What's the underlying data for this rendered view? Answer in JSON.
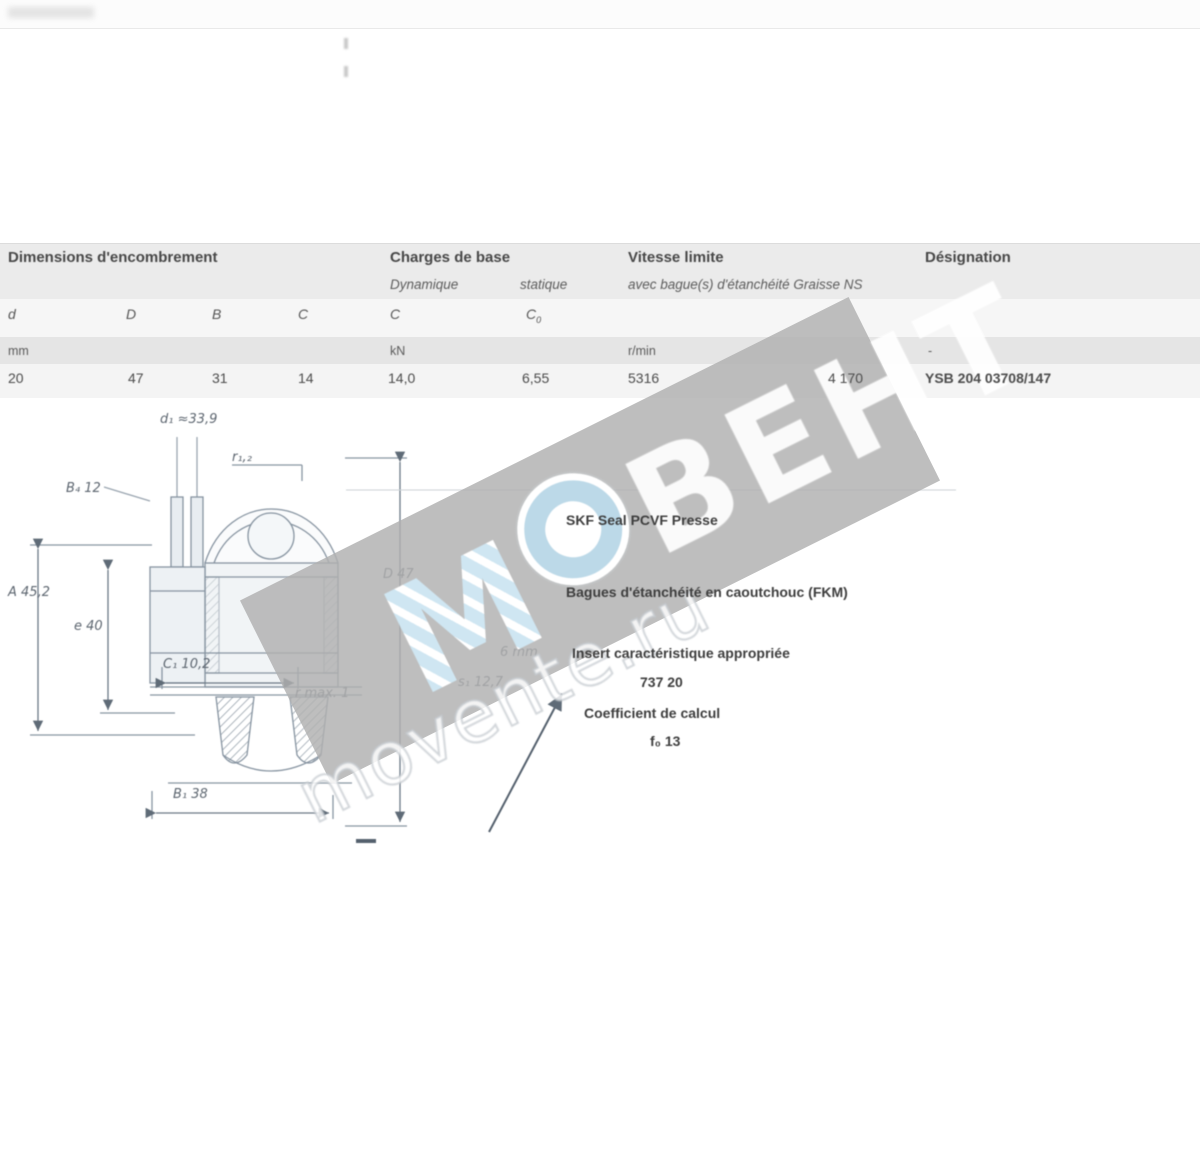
{
  "table": {
    "group1": "Dimensions d'encombrement",
    "group2": "Charges de base",
    "group2_sub1": "Dynamique",
    "group2_sub2": "statique",
    "group3": "Vitesse limite",
    "group3_sub": "avec bague(s) d'étanchéité Graisse NS",
    "group4": "Désignation",
    "symbols": {
      "s1": "d",
      "s2": "D",
      "s3": "B",
      "s4": "C",
      "s5": "C",
      "s6_base": "C",
      "s6_sub": "0"
    },
    "units": {
      "u1": "mm",
      "u2": "kN",
      "u3": "r/min",
      "u4": "-"
    },
    "row": {
      "d": "20",
      "D": "47",
      "B": "31",
      "C": "14",
      "c_dyn": "14,0",
      "c0": "6,55",
      "speed1": "5316",
      "speed2": "4 170",
      "designation": "YSB 204 03708/147"
    }
  },
  "drawing": {
    "labels": {
      "d1": "d₁ ≈33,9",
      "r12": "r₁,₂",
      "b4": "B₄ 12",
      "a": "A 45,2",
      "e": "e 40",
      "dd": "D 47",
      "c1": "C₁ 10,2",
      "rmax": "r max. 1",
      "s1": "s₁ 12,7",
      "mm6": "6 mm",
      "b1": "B₁ 38"
    }
  },
  "annotations": {
    "line1": "SKF Seal PCVF Presse",
    "line2": "Bagues d'étanchéité en caoutchouc (FKM)",
    "line3": "Insert caractéristique appropriée",
    "line3_value": "737 20",
    "line4": "Coefficient de calcul",
    "line4_value": "f₀ 13"
  },
  "watermark": {
    "brand": "ВЕНТ",
    "site": "movente.ru",
    "logo_letter": "М"
  }
}
